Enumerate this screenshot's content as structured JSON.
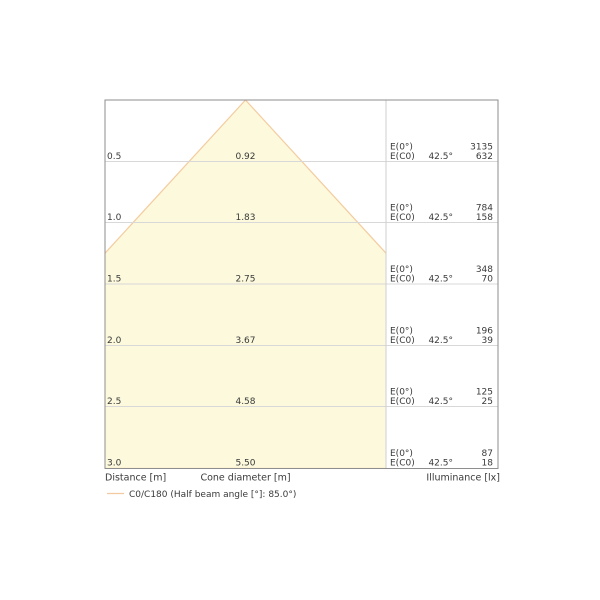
{
  "chart_data": {
    "type": "cone-diagram",
    "title": "Luminaire light cone diagram",
    "distances_m": [
      0.5,
      1.0,
      1.5,
      2.0,
      2.5,
      3.0
    ],
    "cone_diameters_m": [
      0.92,
      1.83,
      2.75,
      3.67,
      4.58,
      5.5
    ],
    "illuminance_e0_lx": [
      3135,
      784,
      348,
      196,
      125,
      87
    ],
    "illuminance_ec0_lx": [
      632,
      158,
      70,
      39,
      25,
      18
    ],
    "beam_half_angle_deg": 42.5,
    "half_beam_angle_deg": 85.0,
    "axis": {
      "distance": "Distance [m]",
      "cone_diameter": "Cone diameter [m]",
      "illuminance": "Illuminance [lx]"
    },
    "legend_label": "C0/C180 (Half beam angle [°]: 85.0°)",
    "rows": [
      {
        "distance": "0.5",
        "diameter": "0.92",
        "e0_label": "E(0°)",
        "ec0_label": "E(C0)",
        "angle": "42.5°",
        "e0": "3135",
        "ec0": "632"
      },
      {
        "distance": "1.0",
        "diameter": "1.83",
        "e0_label": "E(0°)",
        "ec0_label": "E(C0)",
        "angle": "42.5°",
        "e0": "784",
        "ec0": "158"
      },
      {
        "distance": "1.5",
        "diameter": "2.75",
        "e0_label": "E(0°)",
        "ec0_label": "E(C0)",
        "angle": "42.5°",
        "e0": "348",
        "ec0": "70"
      },
      {
        "distance": "2.0",
        "diameter": "3.67",
        "e0_label": "E(0°)",
        "ec0_label": "E(C0)",
        "angle": "42.5°",
        "e0": "196",
        "ec0": "39"
      },
      {
        "distance": "2.5",
        "diameter": "4.58",
        "e0_label": "E(0°)",
        "ec0_label": "E(C0)",
        "angle": "42.5°",
        "e0": "125",
        "ec0": "25"
      },
      {
        "distance": "3.0",
        "diameter": "5.50",
        "e0_label": "E(0°)",
        "ec0_label": "E(C0)",
        "angle": "42.5°",
        "e0": "87",
        "ec0": "18"
      }
    ],
    "colors": {
      "cone_fill": "#FCF9DC",
      "cone_edge": "#F4CCA0",
      "legend_line": "#F2C9A1"
    },
    "layout_hints": {
      "grid": "horizontal lines at each distance step",
      "legend_position": "bottom-left",
      "value_columns_position": "right"
    }
  }
}
